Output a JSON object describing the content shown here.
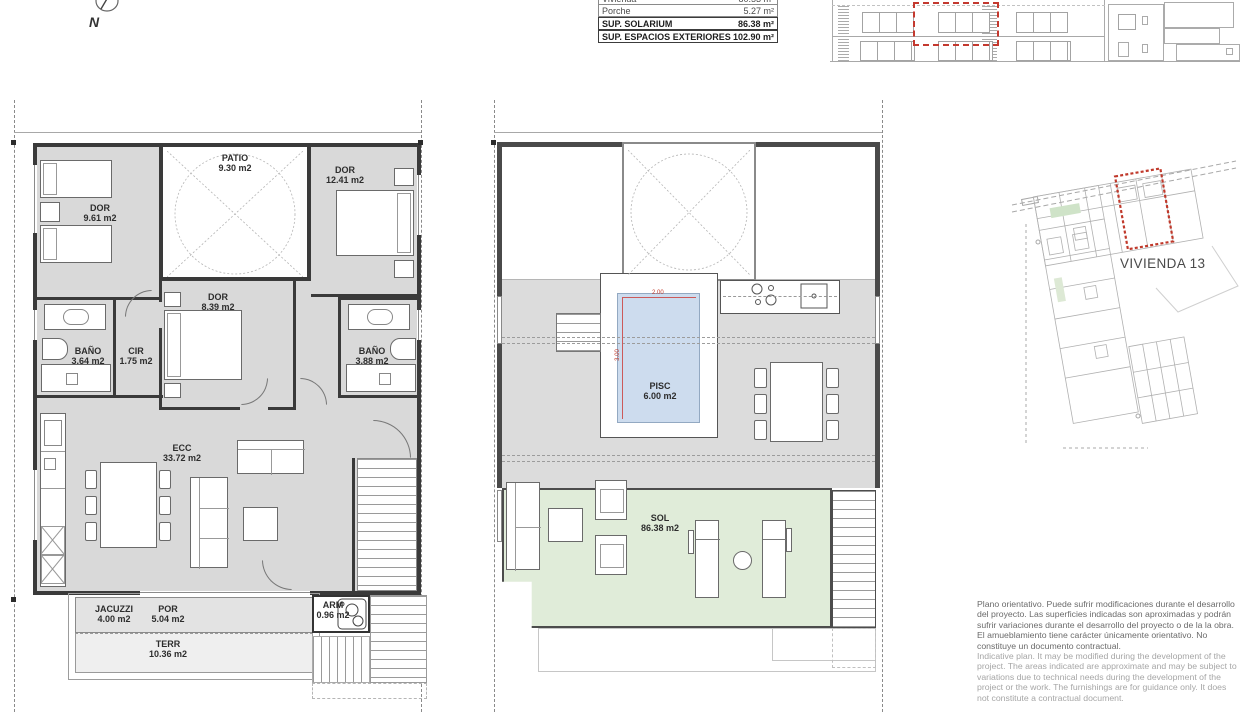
{
  "compass": {
    "label": "N"
  },
  "areas_table": {
    "rows": [
      {
        "label": "Vivienda",
        "value": "80.53 m²"
      },
      {
        "label": "Porche",
        "value": "5.27 m²"
      },
      {
        "label": "SUP. SOLARIUM",
        "value": "86.38 m²"
      },
      {
        "label": "SUP. ESPACIOS EXTERIORES",
        "value": "102.90 m²"
      }
    ]
  },
  "floor_plan": {
    "rooms": [
      {
        "name": "DOR",
        "area": "9.61 m2"
      },
      {
        "name": "PATIO",
        "area": "9.30 m2"
      },
      {
        "name": "DOR",
        "area": "12.41 m2"
      },
      {
        "name": "BAÑO",
        "area": "3.64 m2"
      },
      {
        "name": "CIR",
        "area": "1.75 m2"
      },
      {
        "name": "DOR",
        "area": "8.39 m2"
      },
      {
        "name": "BAÑO",
        "area": "3.88 m2"
      },
      {
        "name": "ECC",
        "area": "33.72 m2"
      },
      {
        "name": "JACUZZI",
        "area": "4.00 m2"
      },
      {
        "name": "POR",
        "area": "5.04 m2"
      },
      {
        "name": "ARM",
        "area": "0.96 m2"
      },
      {
        "name": "TERR",
        "area": "10.36 m2"
      }
    ]
  },
  "solarium_plan": {
    "rooms": [
      {
        "name": "PISC",
        "area": "6.00 m2"
      },
      {
        "name": "SOL",
        "area": "86.38 m2"
      }
    ],
    "pool_dimensions": {
      "width": "2.00",
      "length": "3.00"
    }
  },
  "site_plan": {
    "unit_label": "VIVIENDA 13"
  },
  "disclaimer": {
    "spanish": "Plano orientativo. Puede sufrir modificaciones durante el desarrollo del proyecto. Las superficies indicadas son aproximadas y podrán sufrir variaciones durante el desarrollo del proyecto o de la la obra. El amueblamiento tiene carácter únicamente orientativo. No constituye un documento contractual.",
    "english": "Indicative plan. It may be modified during the development of the project. The areas indicated are approximate and may be subject to variations due to technical needs during the development of the project or the work. The furnishings are for guidance only. It does not constitute a contractual document."
  },
  "colors": {
    "highlight_red": "#c0392b",
    "pool_blue": "#cddcee",
    "solarium_green": "#e0ecd9",
    "room_gray": "#d9d9d9"
  }
}
